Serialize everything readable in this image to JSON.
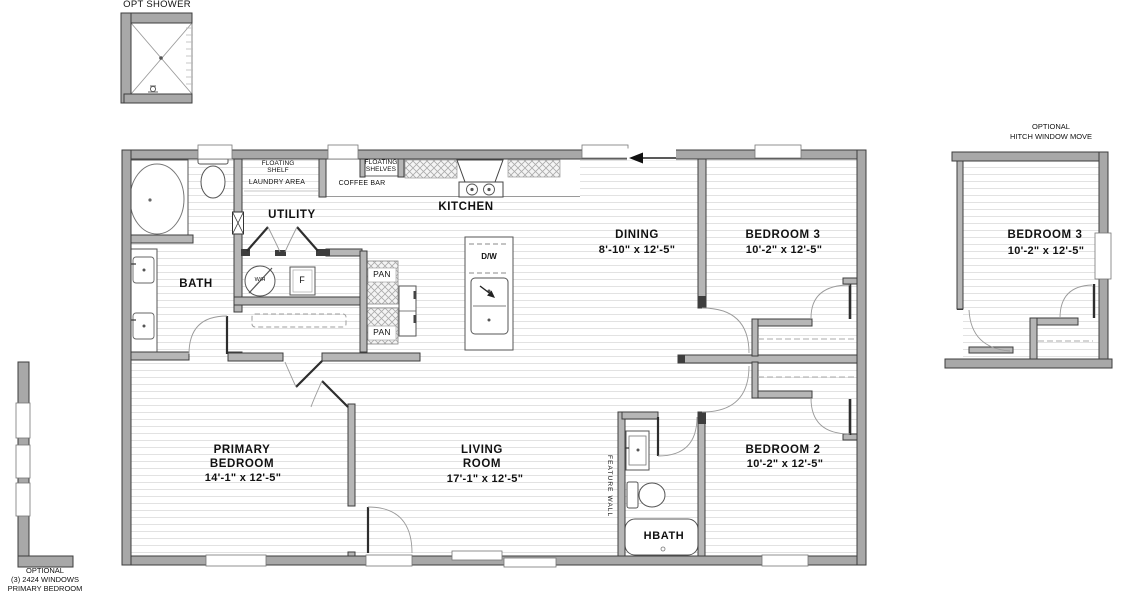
{
  "details": {
    "opt_shower": {
      "label": "OPT SHOWER"
    },
    "optional_windows": {
      "line1": "OPTIONAL",
      "line2": "(3) 2424 WINDOWS",
      "line3": "PRIMARY BEDROOM"
    },
    "hitch_window": {
      "line1": "OPTIONAL",
      "line2": "HITCH WINDOW MOVE",
      "room": {
        "name": "BEDROOM 3",
        "dims": "10'-2\" x  12'-5\""
      }
    }
  },
  "rooms": {
    "bath": {
      "name": "BATH"
    },
    "utility": {
      "name": "UTILITY"
    },
    "kitchen": {
      "name": "KITCHEN"
    },
    "dining": {
      "name": "DINING",
      "dims": "8'-10\" x  12'-5\""
    },
    "bedroom3": {
      "name": "BEDROOM 3",
      "dims": "10'-2\" x  12'-5\""
    },
    "bedroom2": {
      "name": "BEDROOM 2",
      "dims": "10'-2\" x  12'-5\""
    },
    "primary_bedroom": {
      "name1": "PRIMARY",
      "name2": "BEDROOM",
      "dims": "14'-1\" x  12'-5\""
    },
    "living_room": {
      "name1": "LIVING",
      "name2": "ROOM",
      "dims": "17'-1\" x  12'-5\""
    },
    "hbath": {
      "name": "HBATH"
    }
  },
  "features": {
    "floating_shelf": {
      "line1": "FLOATING",
      "line2": "SHELF"
    },
    "laundry_area": "LAUNDRY AREA",
    "floating_shelves": {
      "line1": "FLOATING",
      "line2": "SHELVES"
    },
    "coffee_bar": "COFFEE BAR",
    "pantry1": "PAN",
    "pantry2": "PAN",
    "dishwasher": "D/W",
    "water_heater": "W/H",
    "furnace": "F",
    "feature_wall": "FEATURE WALL"
  },
  "colors": {
    "wall_fill": "#a8a8a8",
    "interior_wall_fill": "#b6b6b6",
    "outline": "#3d3d3d",
    "floor_line": "#e2e2e2"
  }
}
